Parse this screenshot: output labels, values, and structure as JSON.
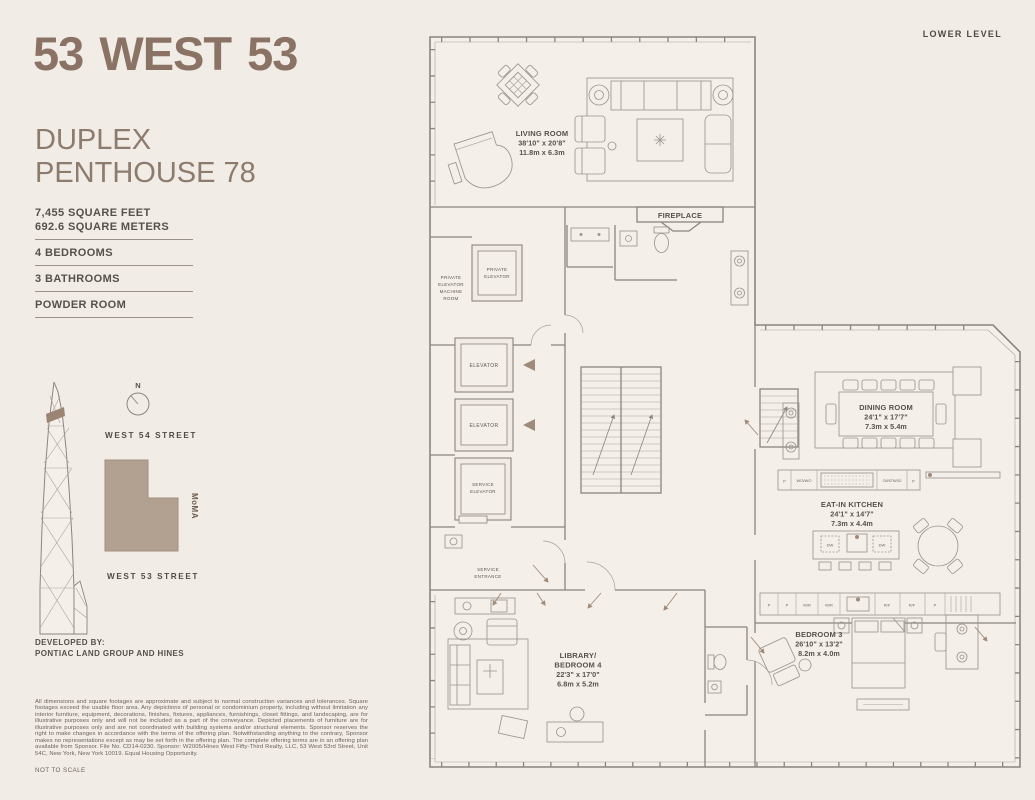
{
  "header": {
    "brand": "53 WEST 53",
    "level_label": "LOWER LEVEL",
    "unit_line1": "DUPLEX",
    "unit_line2": "PENTHOUSE 78"
  },
  "stats": {
    "area_ft": "7,455 SQUARE FEET",
    "area_m": "692.6 SQUARE METERS",
    "bedrooms": "4 BEDROOMS",
    "bathrooms": "3 BATHROOMS",
    "powder": "POWDER ROOM"
  },
  "location_map": {
    "compass": "N",
    "street_top": "WEST 54 STREET",
    "street_bottom": "WEST 53 STREET",
    "landmark": "MoMA",
    "footprint_color": "#b2a091"
  },
  "developer": {
    "heading": "DEVELOPED BY:",
    "name": "PONTIAC LAND GROUP AND HINES"
  },
  "legal": {
    "disclaimer": "All dimensions and square footages are approximate and subject to normal construction variances and tolerances. Square footages exceed the usable floor area. Any depictions of personal or condominium property, including without limitation any interior furniture, equipment, decorations, finishes, fixtures, appliances, furnishings, closet fittings, and landscaping, are for illustrative purposes only and will not be included as a part of the conveyance. Depicted placements of furniture are for illustrative purposes only and are not coordinated with building systems and/or structural elements. Sponsor reserves the right to make changes in accordance with the terms of the offering plan. Notwithstanding anything to the contrary, Sponsor makes no representations except as may be set forth in the offering plan. The complete offering terms are in an offering plan available from Sponsor. File No. CD14-0230. Sponsor: W2005/Hines West Fifty-Third Realty, LLC, 53 West 53rd Street, Unit 54C, New York, New York 10019. Equal Housing Opportunity.",
    "scale_note": "NOT TO SCALE"
  },
  "plan": {
    "rooms": {
      "living_room": {
        "name": "LIVING ROOM",
        "dims_ft": "38'10\" x 20'8\"",
        "dims_m": "11.8m x 6.3m"
      },
      "dining_room": {
        "name": "DINING ROOM",
        "dims_ft": "24'1\" x 17'7\"",
        "dims_m": "7.3m x 5.4m"
      },
      "eat_in_kitchen": {
        "name": "EAT-IN KITCHEN",
        "dims_ft": "24'1\" x 14'7\"",
        "dims_m": "7.3m x 4.4m"
      },
      "bedroom_3": {
        "name": "BEDROOM 3",
        "dims_ft": "26'10\" x 13'2\"",
        "dims_m": "8.2m x 4.0m"
      },
      "library_bedroom_4": {
        "name_line1": "LIBRARY/",
        "name_line2": "BEDROOM 4",
        "dims_ft": "22'3\" x 17'0\"",
        "dims_m": "6.8m x 5.2m"
      },
      "fireplace": "FIREPLACE",
      "private_elevator": {
        "line1": "PRIVATE",
        "line2": "ELEVATOR"
      },
      "machine_room": {
        "line1": "PRIVATE",
        "line2": "ELEVATOR",
        "line3": "MACHINE",
        "line4": "ROOM"
      },
      "elevator_a": "ELEVATOR",
      "elevator_b": "ELEVATOR",
      "service_elevator": {
        "line1": "SERVICE",
        "line2": "ELEVATOR"
      },
      "service_entrance": {
        "line1": "SERVICE",
        "line2": "ENTRANCE"
      }
    },
    "appliances": {
      "pantry": "P",
      "wall_ovens": "WO/WO",
      "coffee_steam_speed_ovens": "CM/STM/SO",
      "dishwasher": "DW",
      "wine_refrigerator": "W/R",
      "refrigerator_freezer": "R/F"
    },
    "accent_color": "#a08b7a"
  },
  "colors": {
    "background": "#f1ece5",
    "brand_brown": "#8a7364",
    "wall_gray": "#8a857f",
    "text_dark": "#56514b"
  }
}
